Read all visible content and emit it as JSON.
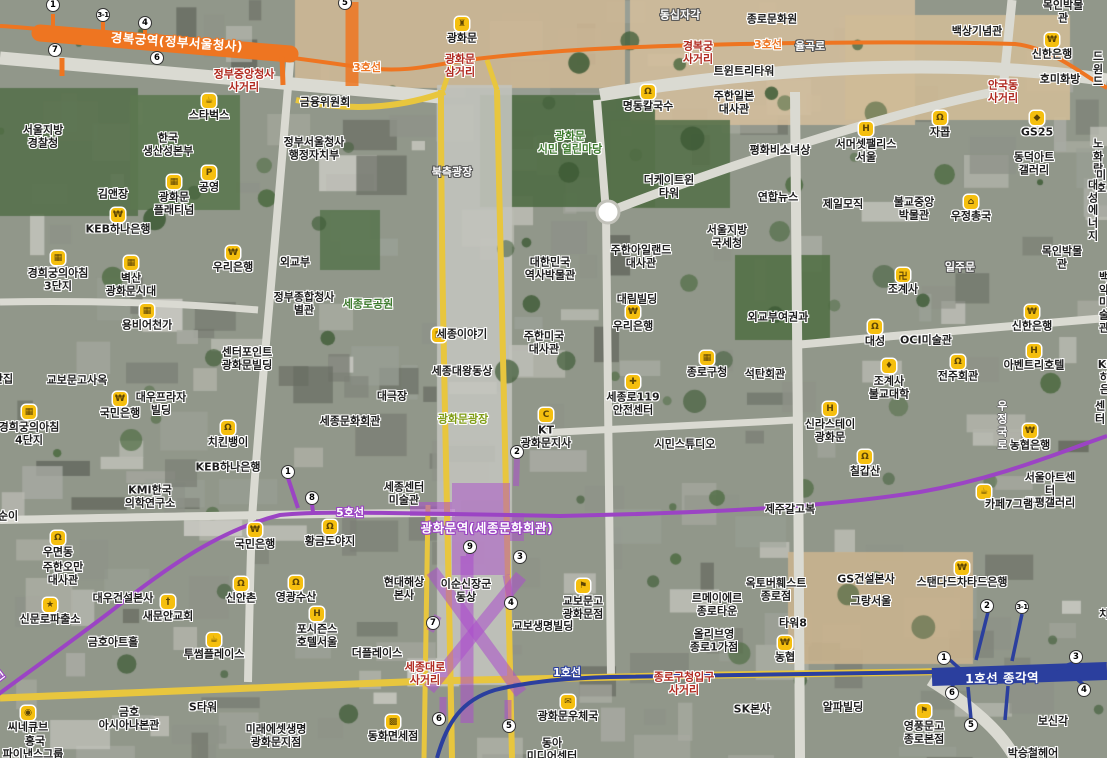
{
  "colors": {
    "line1": "#2b3f9e",
    "line3": "#ee7521",
    "line5": "#9b44c4",
    "station_area_fill": "rgba(171,77,204,0.50)",
    "station_area_stroke": "rgba(171,77,204,0.55)",
    "road_major": "#e8c63e",
    "road_minor": "#dadad2",
    "label_red": "#b02a20",
    "label_green": "#3d7a2d",
    "label_lime": "#7f9c14",
    "poi_icon_bg": "#f5bf0f"
  },
  "subway": {
    "stations": [
      {
        "name": "경복궁역(정부서울청사)",
        "line": "line3",
        "x": 177,
        "y": 41,
        "rot": 4
      },
      {
        "name": "광화문역(세종문화회관)",
        "line": "line5",
        "x": 487,
        "y": 527,
        "rot": 0
      },
      {
        "name": "1호선  종각역",
        "line": "line1",
        "x": 1002,
        "y": 677,
        "rot": -1
      }
    ],
    "line_labels": [
      {
        "text": "3호선",
        "line": "line3",
        "x": 367,
        "y": 67,
        "rot": 0
      },
      {
        "text": "3호선",
        "line": "line3",
        "x": 768,
        "y": 44,
        "rot": 0
      },
      {
        "text": "5호선",
        "line": "line5",
        "x": 350,
        "y": 512,
        "rot": 0
      },
      {
        "text": "5호선",
        "line": "line5",
        "x": -8,
        "y": 681,
        "rot": -38
      },
      {
        "text": "1호선",
        "line": "line1",
        "x": 567,
        "y": 672,
        "rot": 0
      }
    ],
    "exits": [
      {
        "line": "line3",
        "n": "1",
        "x": 53,
        "y": 5
      },
      {
        "line": "line3",
        "n": "3-1",
        "x": 103,
        "y": 15
      },
      {
        "line": "line3",
        "n": "4",
        "x": 145,
        "y": 23
      },
      {
        "line": "line3",
        "n": "7",
        "x": 55,
        "y": 50
      },
      {
        "line": "line3",
        "n": "6",
        "x": 157,
        "y": 58
      },
      {
        "line": "line3",
        "n": "5",
        "x": 345,
        "y": 3
      },
      {
        "line": "line5",
        "n": "1",
        "x": 288,
        "y": 472
      },
      {
        "line": "line5",
        "n": "8",
        "x": 312,
        "y": 498
      },
      {
        "line": "line5",
        "n": "2",
        "x": 517,
        "y": 452
      },
      {
        "line": "line5",
        "n": "9",
        "x": 470,
        "y": 547
      },
      {
        "line": "line5",
        "n": "3",
        "x": 520,
        "y": 557
      },
      {
        "line": "line5",
        "n": "4",
        "x": 511,
        "y": 603
      },
      {
        "line": "line5",
        "n": "7",
        "x": 433,
        "y": 623
      },
      {
        "line": "line5",
        "n": "6",
        "x": 439,
        "y": 719
      },
      {
        "line": "line5",
        "n": "5",
        "x": 509,
        "y": 726
      },
      {
        "line": "line1",
        "n": "2",
        "x": 987,
        "y": 606
      },
      {
        "line": "line1",
        "n": "3-1",
        "x": 1022,
        "y": 607
      },
      {
        "line": "line1",
        "n": "1",
        "x": 944,
        "y": 658
      },
      {
        "line": "line1",
        "n": "3",
        "x": 1076,
        "y": 657
      },
      {
        "line": "line1",
        "n": "6",
        "x": 952,
        "y": 693
      },
      {
        "line": "line1",
        "n": "5",
        "x": 971,
        "y": 725
      },
      {
        "line": "line1",
        "n": "4",
        "x": 1084,
        "y": 690
      }
    ]
  },
  "labels": [
    {
      "t": "서울지방\n경찰청",
      "x": 43,
      "y": 137
    },
    {
      "t": "스타벅스",
      "x": 209,
      "y": 116,
      "i": "cafe"
    },
    {
      "t": "한국\n생산성본부",
      "x": 168,
      "y": 145
    },
    {
      "t": "금융위원회",
      "x": 325,
      "y": 103
    },
    {
      "t": "정부서울청사\n행정자치부",
      "x": 314,
      "y": 149
    },
    {
      "t": "김앤장",
      "x": 113,
      "y": 195
    },
    {
      "t": "광화문\n플래티넘",
      "x": 174,
      "y": 204,
      "i": "bldg"
    },
    {
      "t": "공영",
      "x": 209,
      "y": 188,
      "i": "park"
    },
    {
      "t": "KEB하나은행",
      "x": 118,
      "y": 230,
      "i": "bank"
    },
    {
      "t": "정부중앙청사\n사거리",
      "x": 244,
      "y": 81,
      "c": "r"
    },
    {
      "t": "경희궁의아침\n3단지",
      "x": 58,
      "y": 280,
      "i": "bldg"
    },
    {
      "t": "벽산\n광화문시대",
      "x": 131,
      "y": 285,
      "i": "bldg"
    },
    {
      "t": "용비어천가",
      "x": 147,
      "y": 326,
      "i": "bldg"
    },
    {
      "t": "우리은행",
      "x": 233,
      "y": 268,
      "i": "bank"
    },
    {
      "t": "외교부",
      "x": 295,
      "y": 263
    },
    {
      "t": "정부종합청사\n별관",
      "x": 304,
      "y": 304
    },
    {
      "t": "센터포인트\n광화문빌딩",
      "x": 247,
      "y": 359
    },
    {
      "t": "교보문고사옥",
      "x": 77,
      "y": 381
    },
    {
      "t": "단집",
      "x": 3,
      "y": 380
    },
    {
      "t": "경희궁의아침\n4단지",
      "x": 29,
      "y": 434,
      "i": "bldg"
    },
    {
      "t": "대우프라자\n빌딩",
      "x": 161,
      "y": 404
    },
    {
      "t": "국민은행",
      "x": 120,
      "y": 414,
      "i": "bank"
    },
    {
      "t": "치킨뱅이",
      "x": 228,
      "y": 443,
      "i": "rest"
    },
    {
      "t": "KEB하나은행",
      "x": 228,
      "y": 468
    },
    {
      "t": "KMI한국\n의학연구소",
      "x": 150,
      "y": 497
    },
    {
      "t": "세종로공원",
      "x": 368,
      "y": 305,
      "c": "g"
    },
    {
      "t": "세종문화회관",
      "x": 350,
      "y": 422
    },
    {
      "t": "대극장",
      "x": 392,
      "y": 397
    },
    {
      "t": "광화문",
      "x": 462,
      "y": 39,
      "i": "gate"
    },
    {
      "t": "광화문\n삼거리",
      "x": 460,
      "y": 66,
      "c": "r"
    },
    {
      "t": "북측광장",
      "x": 452,
      "y": 173,
      "c": "w"
    },
    {
      "t": "동십자각",
      "x": 680,
      "y": 16,
      "c": "w"
    },
    {
      "t": "명동칼국수",
      "x": 648,
      "y": 107,
      "i": "rest"
    },
    {
      "t": "광화문\n시민 열린마당",
      "x": 570,
      "y": 143,
      "c": "g"
    },
    {
      "t": "경복궁\n사거리",
      "x": 698,
      "y": 53,
      "c": "r"
    },
    {
      "t": "율곡로",
      "x": 810,
      "y": 47,
      "c": "w"
    },
    {
      "t": "트윈트리타워",
      "x": 744,
      "y": 72
    },
    {
      "t": "주한일본\n대사관",
      "x": 734,
      "y": 103
    },
    {
      "t": "더케이트윈\n타워",
      "x": 669,
      "y": 187
    },
    {
      "t": "평화비소녀상",
      "x": 780,
      "y": 151
    },
    {
      "t": "연합뉴스",
      "x": 778,
      "y": 198
    },
    {
      "t": "제일모직",
      "x": 843,
      "y": 205
    },
    {
      "t": "서울지방\n국세청",
      "x": 727,
      "y": 237
    },
    {
      "t": "주한아일랜드\n대사관",
      "x": 641,
      "y": 257
    },
    {
      "t": "세종이야기",
      "x": 462,
      "y": 335,
      "i": "museum",
      "ix": 439,
      "iy": 335
    },
    {
      "t": "세종대왕동상",
      "x": 462,
      "y": 372
    },
    {
      "t": "광화문광장",
      "x": 463,
      "y": 420,
      "c": "l"
    },
    {
      "t": "대한민국\n역사박물관",
      "x": 550,
      "y": 269
    },
    {
      "t": "주한미국\n대사관",
      "x": 544,
      "y": 343
    },
    {
      "t": "대림빌딩",
      "x": 637,
      "y": 300
    },
    {
      "t": "우리은행",
      "x": 633,
      "y": 327,
      "i": "bank"
    },
    {
      "t": "세종로119\n안전센터",
      "x": 633,
      "y": 404,
      "i": "fire"
    },
    {
      "t": "종로구청",
      "x": 707,
      "y": 373,
      "i": "bldg"
    },
    {
      "t": "KT\n광화문지사",
      "x": 546,
      "y": 437,
      "i": "kt"
    },
    {
      "t": "시민스튜디오",
      "x": 685,
      "y": 445
    },
    {
      "t": "종로문화원",
      "x": 772,
      "y": 20
    },
    {
      "t": "백상기념관",
      "x": 977,
      "y": 32
    },
    {
      "t": "신한은행",
      "x": 1052,
      "y": 55,
      "i": "bank"
    },
    {
      "t": "호미화방",
      "x": 1060,
      "y": 80
    },
    {
      "t": "안국동\n사거리",
      "x": 1003,
      "y": 92,
      "c": "r"
    },
    {
      "t": "드윈드",
      "x": 1098,
      "y": 70
    },
    {
      "t": "GS25",
      "x": 1037,
      "y": 133,
      "i": "store"
    },
    {
      "t": "동덕아트\n갤러리",
      "x": 1034,
      "y": 164
    },
    {
      "t": "노화랑",
      "x": 1098,
      "y": 157
    },
    {
      "t": "미호",
      "x": 1101,
      "y": 182
    },
    {
      "t": "대성\n에너지",
      "x": 1093,
      "y": 211
    },
    {
      "t": "우정총국",
      "x": 971,
      "y": 217,
      "i": "temple"
    },
    {
      "t": "불교중앙\n박물관",
      "x": 914,
      "y": 209
    },
    {
      "t": "목인박물관",
      "x": 1063,
      "y": 12
    },
    {
      "t": "서머셋팰리스\n서울",
      "x": 866,
      "y": 151,
      "i": "bed"
    },
    {
      "t": "자콥",
      "x": 940,
      "y": 133,
      "i": "rest"
    },
    {
      "t": "조계사",
      "x": 903,
      "y": 290,
      "i": "swas"
    },
    {
      "t": "일주문",
      "x": 960,
      "y": 268,
      "c": "w"
    },
    {
      "t": "외교부여권과",
      "x": 778,
      "y": 318
    },
    {
      "t": "대성",
      "x": 875,
      "y": 342,
      "i": "rest"
    },
    {
      "t": "OCI미술관",
      "x": 926,
      "y": 341
    },
    {
      "t": "신한은행",
      "x": 1032,
      "y": 327,
      "i": "bank"
    },
    {
      "t": "백악미술관",
      "x": 1104,
      "y": 303
    },
    {
      "t": "아벤트리호텔",
      "x": 1034,
      "y": 366,
      "i": "hotel"
    },
    {
      "t": "KEB하나은행",
      "x": 1110,
      "y": 378
    },
    {
      "t": "석탄회관",
      "x": 765,
      "y": 375
    },
    {
      "t": "조계사\n불교대학",
      "x": 889,
      "y": 388,
      "i": "grad"
    },
    {
      "t": "전주회관",
      "x": 958,
      "y": 377,
      "i": "rest"
    },
    {
      "t": "신라스테이\n광화문",
      "x": 830,
      "y": 431,
      "i": "hotel"
    },
    {
      "t": "목인박물관",
      "x": 1062,
      "y": 258
    },
    {
      "t": "칠갑산",
      "x": 865,
      "y": 472,
      "i": "rest"
    },
    {
      "t": "농협은행",
      "x": 1030,
      "y": 446,
      "i": "bank"
    },
    {
      "t": "서울아트센터\n공평갤러리",
      "x": 1050,
      "y": 491
    },
    {
      "t": "카페7그램",
      "x": 1009,
      "y": 505,
      "i": "cafe",
      "ix": 984,
      "iy": 492
    },
    {
      "t": "우정국로",
      "x": 1001,
      "y": 426,
      "c": "v"
    },
    {
      "t": "치",
      "x": 1104,
      "y": 615
    },
    {
      "t": "센터",
      "x": 1100,
      "y": 413
    },
    {
      "t": "순이",
      "x": 8,
      "y": 517
    },
    {
      "t": "우면동",
      "x": 58,
      "y": 553,
      "i": "rest"
    },
    {
      "t": "주한오만\n대사관",
      "x": 63,
      "y": 574
    },
    {
      "t": "신문로파출소",
      "x": 50,
      "y": 620,
      "i": "police"
    },
    {
      "t": "대우건설본사",
      "x": 123,
      "y": 599
    },
    {
      "t": "새문안교회",
      "x": 168,
      "y": 617,
      "i": "church"
    },
    {
      "t": "금호아트홀",
      "x": 113,
      "y": 643
    },
    {
      "t": "신안촌",
      "x": 241,
      "y": 599,
      "i": "rest"
    },
    {
      "t": "영광수산",
      "x": 296,
      "y": 598,
      "i": "rest"
    },
    {
      "t": "포시즌스\n호텔서울",
      "x": 317,
      "y": 636,
      "i": "hotel"
    },
    {
      "t": "국민은행",
      "x": 255,
      "y": 545,
      "i": "bank"
    },
    {
      "t": "황금도야지",
      "x": 330,
      "y": 542,
      "i": "rest"
    },
    {
      "t": "투썸플레이스",
      "x": 214,
      "y": 655,
      "i": "cafe"
    },
    {
      "t": "더플레이스",
      "x": 377,
      "y": 654
    },
    {
      "t": "씨네큐브",
      "x": 28,
      "y": 728,
      "i": "cine"
    },
    {
      "t": "흥국",
      "x": 35,
      "y": 742
    },
    {
      "t": "파이낸스그룹",
      "x": 33,
      "y": 755
    },
    {
      "t": "금호\n아시아나본관",
      "x": 129,
      "y": 719
    },
    {
      "t": "S타워",
      "x": 203,
      "y": 708
    },
    {
      "t": "미래에셋생명\n광화문지점",
      "x": 276,
      "y": 736
    },
    {
      "t": "동화면세점",
      "x": 393,
      "y": 737,
      "i": "gift"
    },
    {
      "t": "현대해상\n본사",
      "x": 404,
      "y": 589
    },
    {
      "t": "이순신장군\n동상",
      "x": 466,
      "y": 591
    },
    {
      "t": "교보문고\n광화문점",
      "x": 583,
      "y": 608,
      "i": "book"
    },
    {
      "t": "교보생명빌딩",
      "x": 543,
      "y": 627
    },
    {
      "t": "세종센터\n미술관",
      "x": 404,
      "y": 494
    },
    {
      "t": "세종대로\n사거리",
      "x": 425,
      "y": 674,
      "c": "r"
    },
    {
      "t": "종로구청입구\n사거리",
      "x": 684,
      "y": 684,
      "c": "r"
    },
    {
      "t": "광화문우체국",
      "x": 568,
      "y": 717,
      "i": "mail"
    },
    {
      "t": "동아\n미디어센터",
      "x": 552,
      "y": 750
    },
    {
      "t": "르메이에르\n종로타운",
      "x": 717,
      "y": 605
    },
    {
      "t": "올리브영\n종로1가점",
      "x": 714,
      "y": 641
    },
    {
      "t": "옥토버훼스트\n종로점",
      "x": 776,
      "y": 590
    },
    {
      "t": "GS건설본사",
      "x": 866,
      "y": 580
    },
    {
      "t": "그랑서울",
      "x": 871,
      "y": 602
    },
    {
      "t": "스탠다드차타드은행",
      "x": 962,
      "y": 583,
      "i": "bank"
    },
    {
      "t": "타워8",
      "x": 793,
      "y": 624
    },
    {
      "t": "농협",
      "x": 785,
      "y": 658,
      "i": "bank"
    },
    {
      "t": "제주갈고복",
      "x": 790,
      "y": 510
    },
    {
      "t": "SK본사",
      "x": 752,
      "y": 710
    },
    {
      "t": "알파빌딩",
      "x": 843,
      "y": 708
    },
    {
      "t": "영풍문고\n종로본점",
      "x": 924,
      "y": 733,
      "i": "book"
    },
    {
      "t": "보신각",
      "x": 1053,
      "y": 722
    },
    {
      "t": "박승철헤어",
      "x": 1033,
      "y": 754
    }
  ]
}
